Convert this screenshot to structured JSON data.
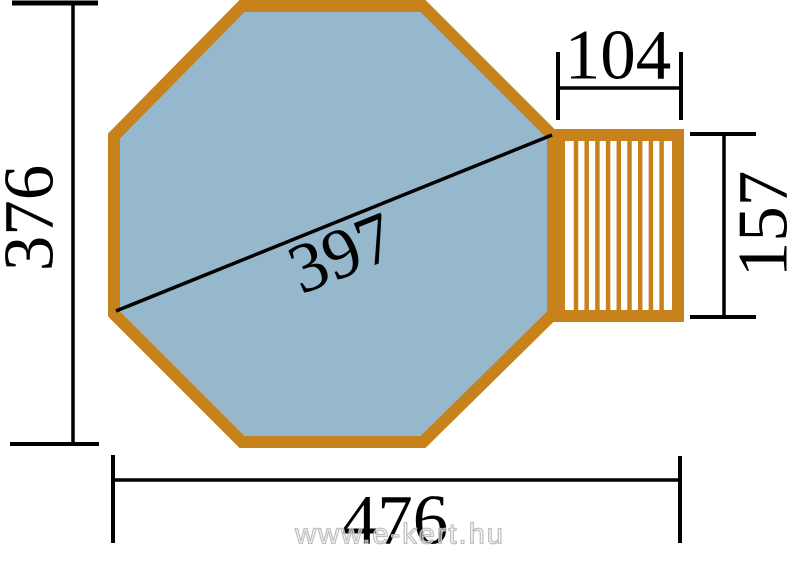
{
  "diagram": {
    "dimensions": {
      "total_height": "376",
      "total_width": "476",
      "diagonal": "397",
      "deck_width": "104",
      "deck_height": "157"
    },
    "watermark": "www.e-kert.hu"
  },
  "colors": {
    "pool-border": "#C8821B",
    "pool-fill": "#95B8CC",
    "dim-line": "#000000",
    "watermark-stroke": "#C0C0C0"
  }
}
